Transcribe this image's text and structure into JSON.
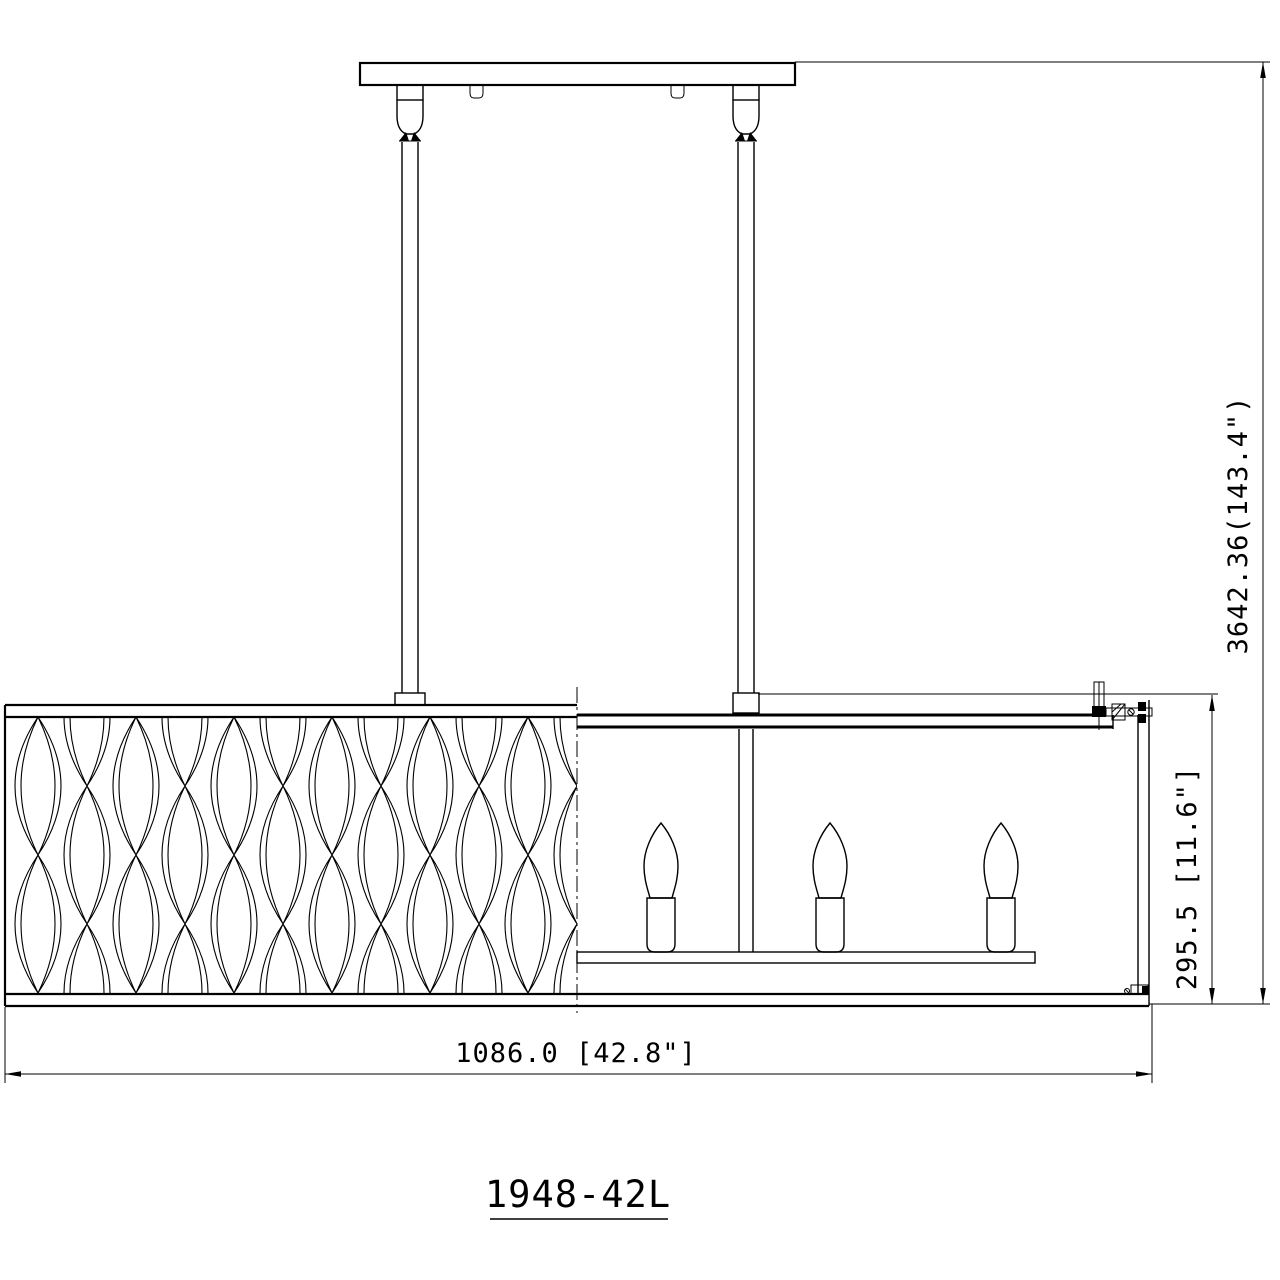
{
  "drawing": {
    "model_label": "1948-42L",
    "dimensions": {
      "overall_height": "3642.36(143.4\")",
      "shade_height": "295.5 [11.6\"]",
      "overall_width": "1086.0 [42.8\"]"
    },
    "colors": {
      "line": "#000000",
      "background": "#ffffff"
    },
    "parts": {
      "canopy": "ceiling-canopy",
      "rods": "hanging-rods",
      "shade": "rectangular-shade-wave-pattern",
      "lamps": "three-candelabra-sockets"
    }
  }
}
